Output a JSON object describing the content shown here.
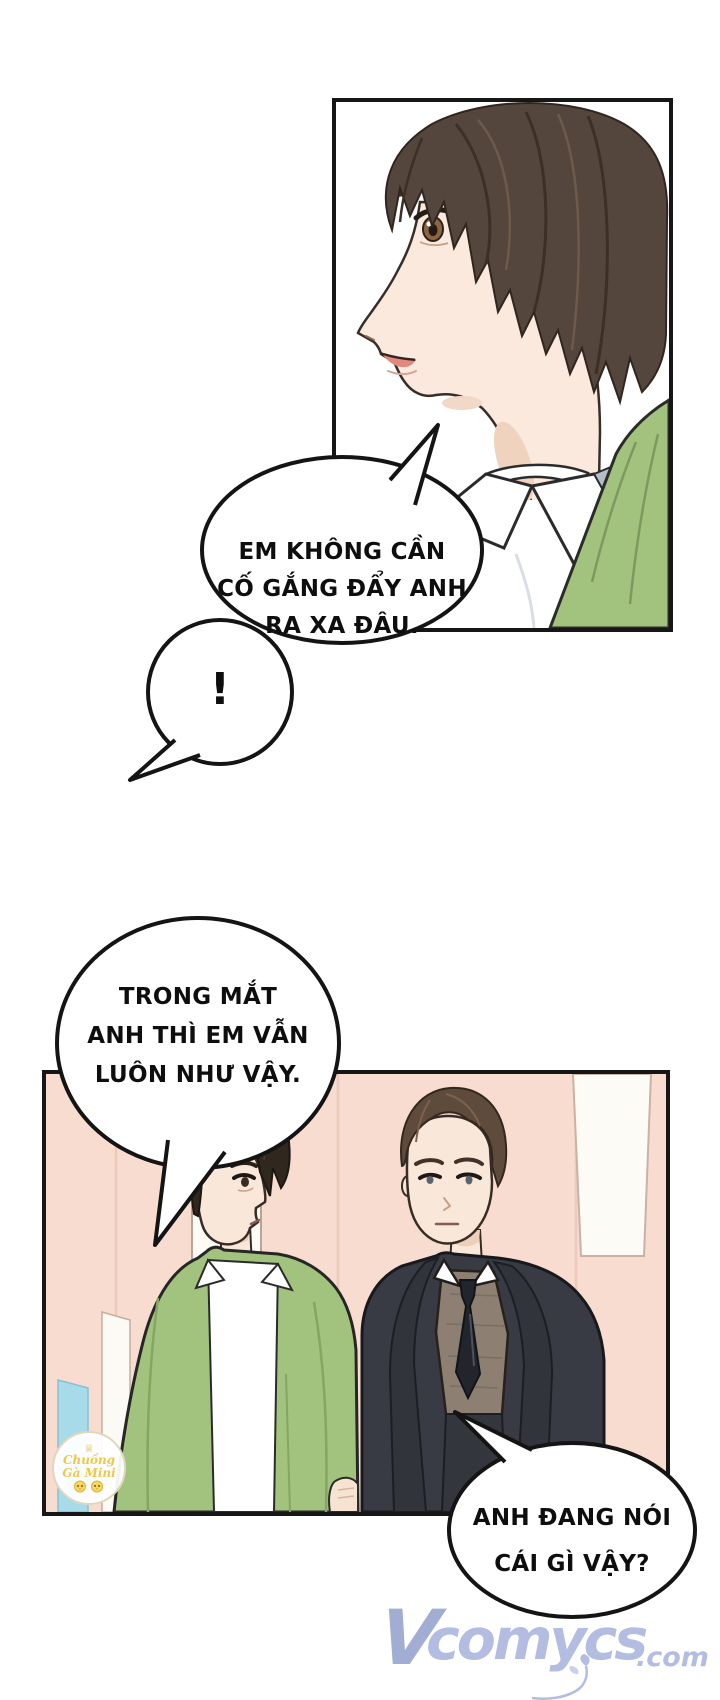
{
  "page": {
    "type": "comic-page",
    "background": "#ffffff"
  },
  "bubbles": {
    "b1": {
      "lines": [
        "EM KHÔNG CẦN",
        "CỐ GẮNG ĐẨY ANH",
        "RA XA ĐÂU."
      ]
    },
    "bang": {
      "text": "!"
    },
    "b2": {
      "lines": [
        "TRONG MẮT",
        "ANH THÌ EM VẪN",
        "LUÔN NHƯ VẬY."
      ]
    },
    "b3": {
      "lines": [
        "ANH ĐANG NÓI",
        "CÁI GÌ VẬY?"
      ]
    }
  },
  "stamp": {
    "crown_icon": "♕",
    "line1": "Chuồng",
    "line2": "Gà Mini"
  },
  "watermark": {
    "initial": "V",
    "name": "comycs",
    "suffix": ".com"
  },
  "colors": {
    "bubble_stroke": "#141414",
    "wall_pink": "#f8dcd0",
    "jacket_green": "#a2c37e",
    "suit_charcoal": "#383b43",
    "vest_taupe": "#8d8073",
    "shirt_white": "#ffffff",
    "skin": "#fae9dc",
    "hair_brown_dark": "#54463c",
    "hair_black": "#30271f",
    "hair_brown": "#5e4b3c",
    "door_blue": "#a7dbe9",
    "watermark_periwinkle": "#a9b3dd",
    "stamp_yellow": "#eec84a"
  }
}
